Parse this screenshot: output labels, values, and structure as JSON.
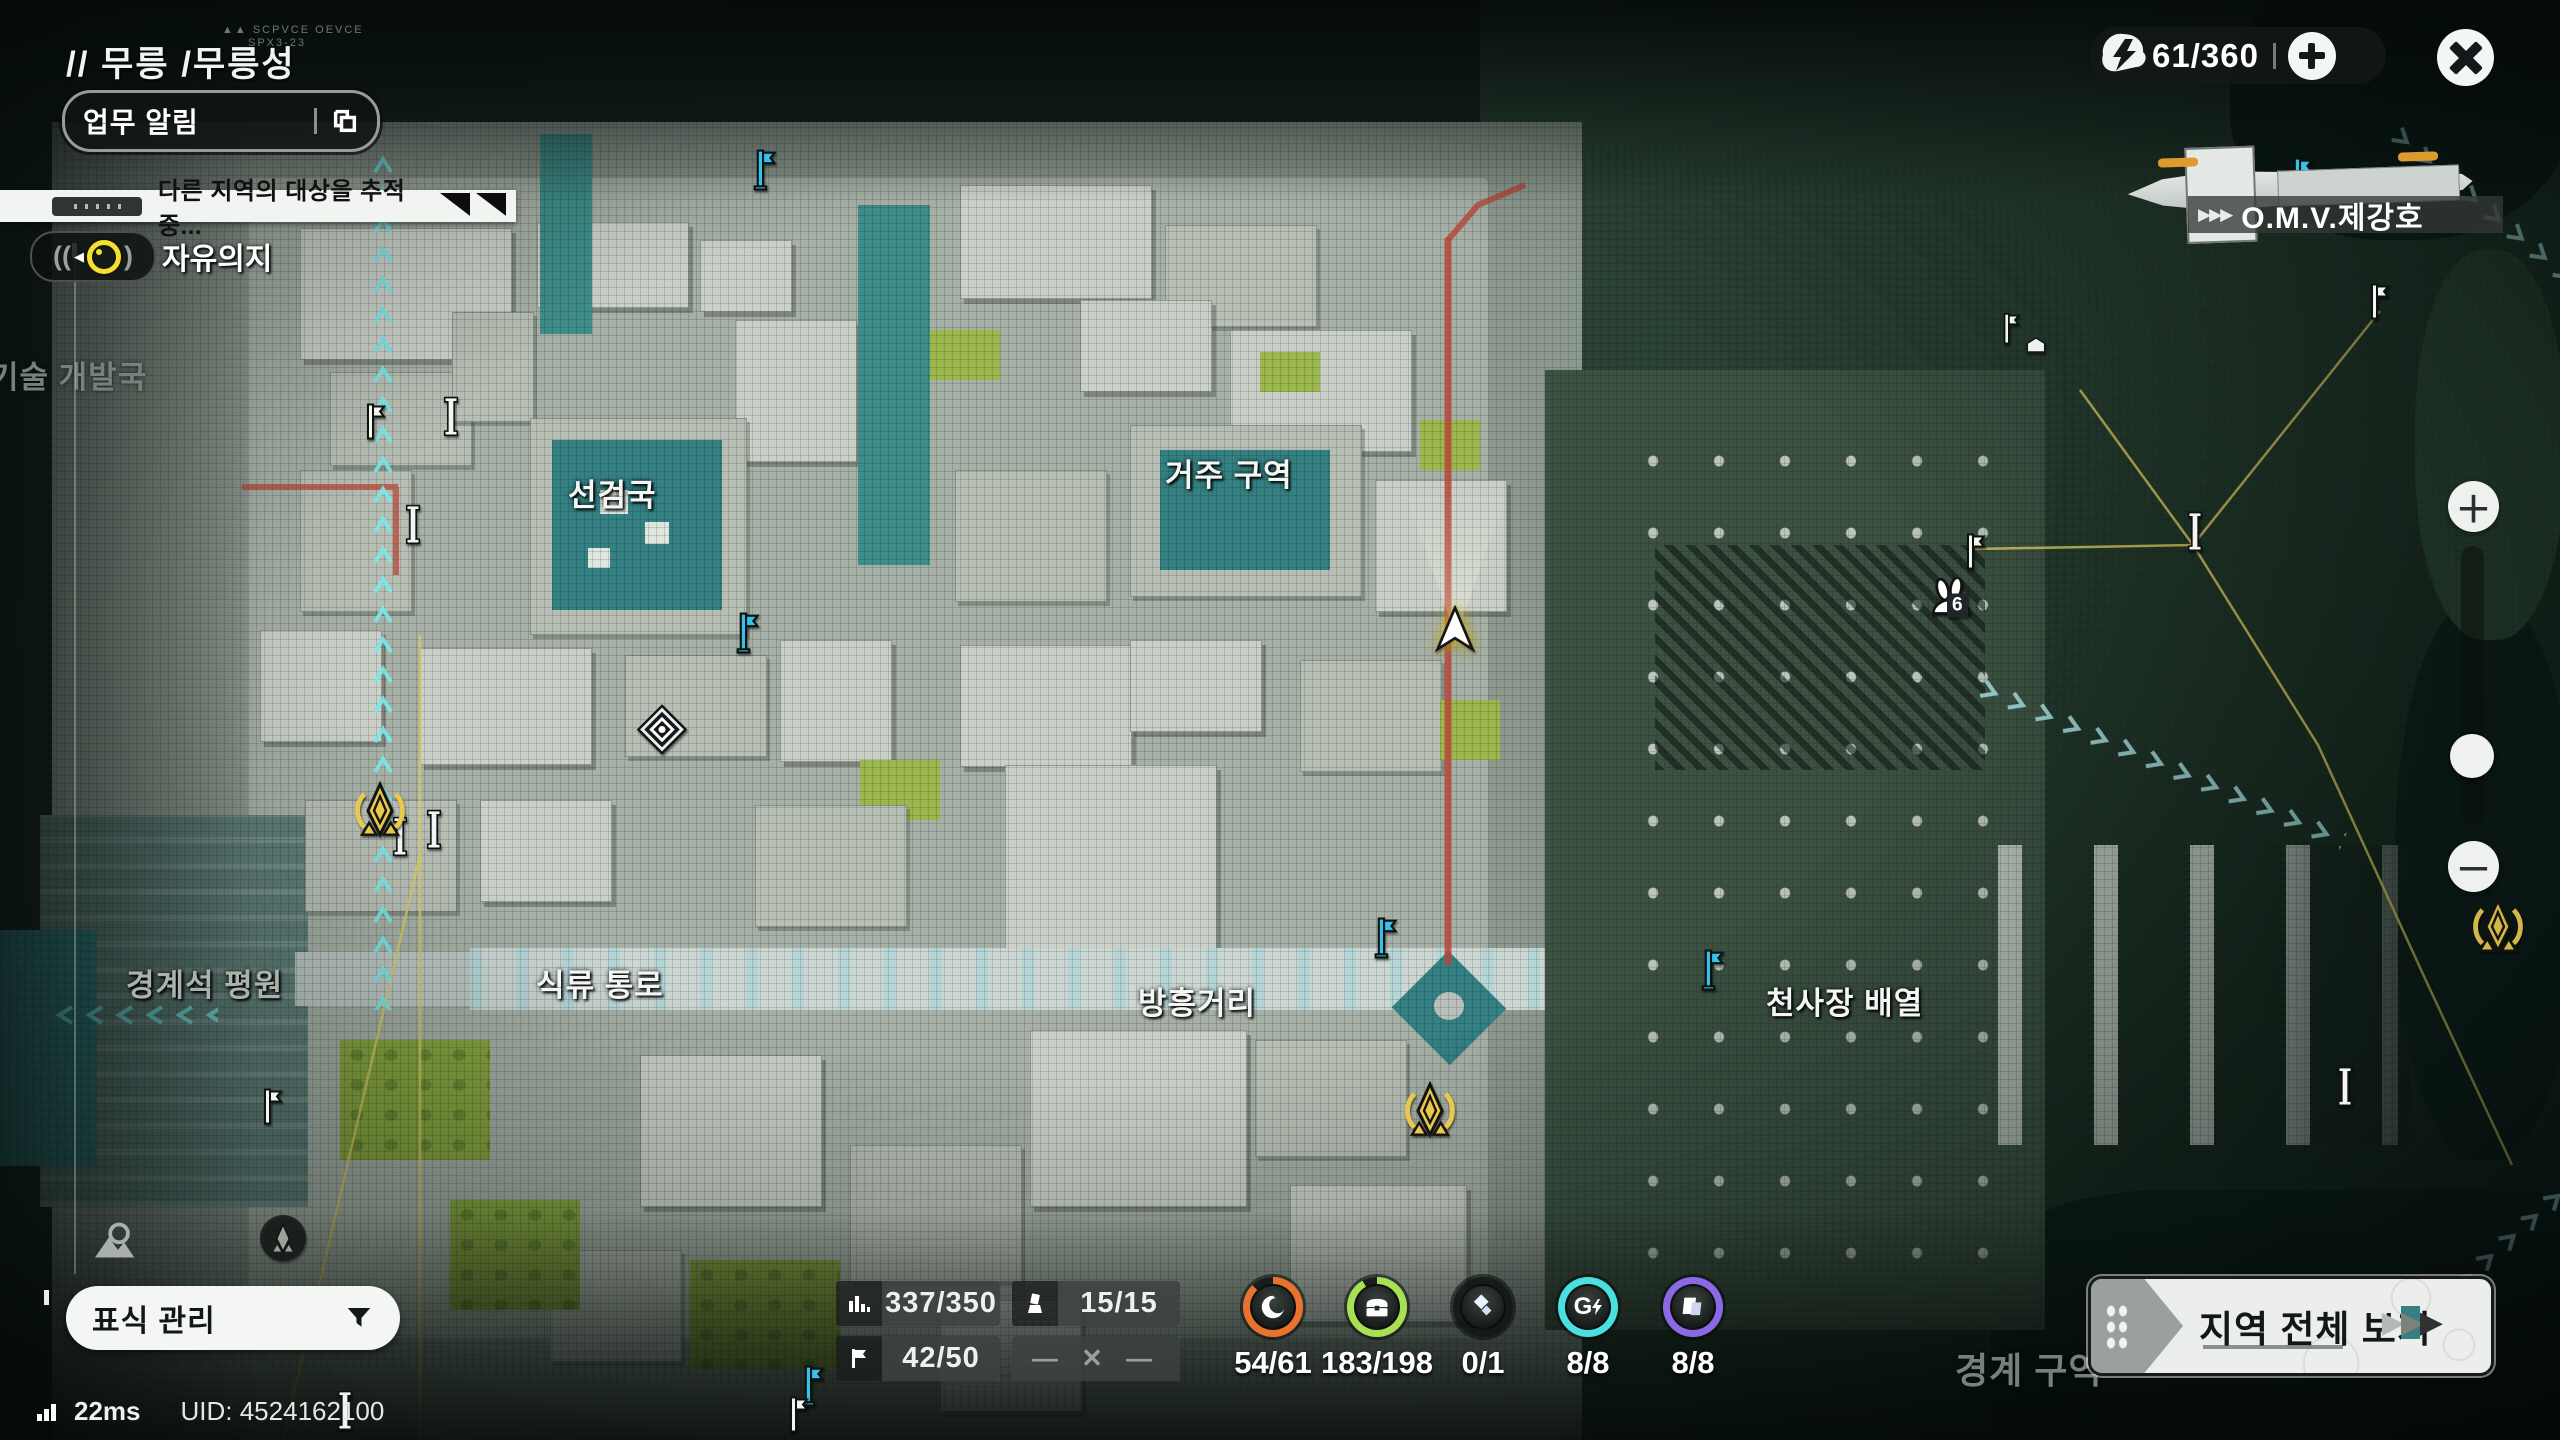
{
  "hud": {
    "breadcrumb": "// 무릉 /무릉성",
    "device_tag_1": "SCPVCE OEVCE",
    "device_tag_2": "SPX3-23",
    "task_alert_button": "업무 알림",
    "tracking_notice": "다른 지역의 대상을 추적 중...",
    "tracker_label": "자유의지",
    "energy_counter": "61/360",
    "ship_name": "O.M.V.제강호",
    "marker_manage_button": "표식 관리",
    "region_overview_button": "지역 전체 보기",
    "ping": "22ms",
    "uid": "UID: 4524162100"
  },
  "map_labels": {
    "tech_bureau": "기술 개발국",
    "seongeomguk": "선검국",
    "residential": "거주 구역",
    "boundary_plain": "경계석 평원",
    "food_passage": "식류 통로",
    "bangheung_street": "방흥거리",
    "cheonsajang_array": "천사장 배열",
    "boundary_zone": "경계 구역"
  },
  "markers": {
    "rabbit_count": "6"
  },
  "stats": {
    "exploration": "337/350",
    "observation": "15/15",
    "flags": "42/50",
    "locked": "— ✕ —",
    "rings": [
      {
        "value": "54/61",
        "color": "#e8722e",
        "progress": 88
      },
      {
        "value": "183/198",
        "color": "#a7e052",
        "progress": 92
      },
      {
        "value": "0/1",
        "color": "#2f3a38",
        "progress": 0
      },
      {
        "value": "8/8",
        "color": "#4ae0e0",
        "progress": 100
      },
      {
        "value": "8/8",
        "color": "#8a68e6",
        "progress": 100
      }
    ]
  },
  "colors": {
    "accent_cyan": "#35c1ec",
    "accent_gold": "#e9c84e",
    "road_red": "#b5473a",
    "route_yellow": "#d9ca5f"
  }
}
